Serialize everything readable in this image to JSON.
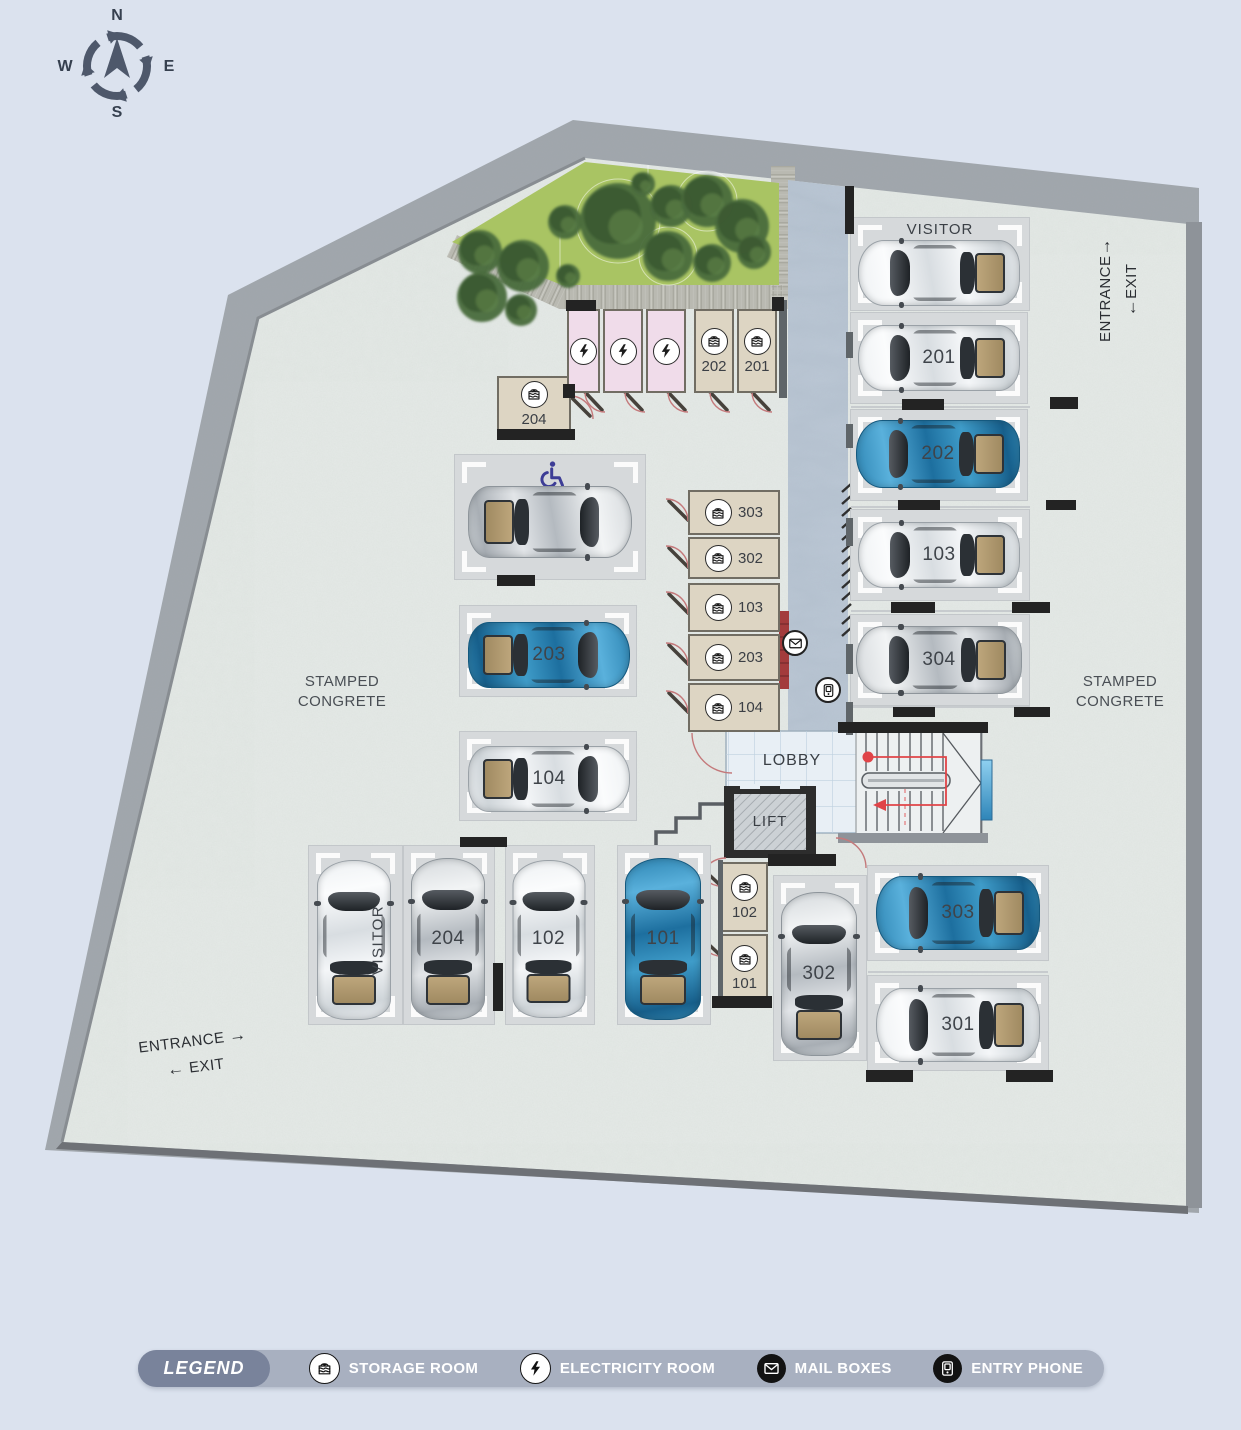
{
  "compass": {
    "north": "N",
    "east": "E",
    "south": "S",
    "west": "W"
  },
  "plan": {
    "lobby_label": "LOBBY",
    "lift_label": "LIFT",
    "surface_left": {
      "line1": "STAMPED",
      "line2": "CONGRETE"
    },
    "surface_right": {
      "line1": "STAMPED",
      "line2": "CONGRETE"
    },
    "entrance_right": {
      "entrance": "ENTRANCE",
      "exit": "EXIT",
      "entrance_arrow": "→",
      "exit_arrow": "←"
    },
    "entrance_bottom": {
      "entrance": "ENTRANCE",
      "exit": "EXIT",
      "entrance_arrow": "→",
      "exit_arrow": "←"
    }
  },
  "parking_stalls": [
    {
      "id": "visitor-top",
      "label": "VISITOR",
      "label_style": "top",
      "car": "white",
      "rect": [
        851,
        218,
        178,
        92
      ],
      "car_rect": [
        858,
        240,
        162,
        66
      ],
      "rot": -90
    },
    {
      "id": "201",
      "label": "201",
      "label_style": "on-car",
      "car": "white",
      "rect": [
        851,
        313,
        176,
        90
      ],
      "car_rect": [
        858,
        325,
        162,
        66
      ],
      "rot": -90
    },
    {
      "id": "202",
      "label": "202",
      "label_style": "on-car",
      "car": "blue",
      "rect": [
        851,
        410,
        176,
        90
      ],
      "car_rect": [
        856,
        420,
        164,
        68
      ],
      "rot": -90
    },
    {
      "id": "103",
      "label": "103",
      "label_style": "on-car",
      "car": "white",
      "rect": [
        851,
        510,
        178,
        90
      ],
      "car_rect": [
        858,
        522,
        162,
        66
      ],
      "rot": -90
    },
    {
      "id": "304",
      "label": "304",
      "label_style": "on-car",
      "car": "silver",
      "rect": [
        851,
        615,
        178,
        90
      ],
      "car_rect": [
        856,
        626,
        166,
        68
      ],
      "rot": -90
    },
    {
      "id": "handicap",
      "label": "",
      "label_style": "handicap",
      "car": "silver",
      "rect": [
        455,
        455,
        190,
        124
      ],
      "car_rect": [
        468,
        486,
        164,
        72
      ],
      "rot": 90
    },
    {
      "id": "203",
      "label": "203",
      "label_style": "on-car",
      "car": "blue",
      "rect": [
        460,
        606,
        176,
        90
      ],
      "car_rect": [
        468,
        622,
        162,
        66
      ],
      "rot": 90
    },
    {
      "id": "104",
      "label": "104",
      "label_style": "on-car",
      "car": "white",
      "rect": [
        460,
        732,
        176,
        88
      ],
      "car_rect": [
        468,
        746,
        162,
        66
      ],
      "rot": 90
    },
    {
      "id": "visitor-bottom",
      "label": "VISITOR",
      "label_style": "side",
      "car": "white",
      "rect": [
        309,
        846,
        93,
        178
      ],
      "car_rect": [
        317,
        860,
        74,
        160
      ],
      "rot": 0
    },
    {
      "id": "204",
      "label": "204",
      "label_style": "on-car",
      "car": "silver",
      "rect": [
        404,
        846,
        90,
        178
      ],
      "car_rect": [
        411,
        858,
        74,
        162
      ],
      "rot": 0
    },
    {
      "id": "102",
      "label": "102",
      "label_style": "on-car",
      "car": "white",
      "rect": [
        506,
        846,
        88,
        178
      ],
      "car_rect": [
        512,
        860,
        73,
        158
      ],
      "rot": 0
    },
    {
      "id": "101",
      "label": "101",
      "label_style": "on-car",
      "car": "blue",
      "rect": [
        618,
        846,
        92,
        178
      ],
      "car_rect": [
        625,
        858,
        76,
        162
      ],
      "rot": 0
    },
    {
      "id": "302",
      "label": "302",
      "label_style": "on-car",
      "car": "silver",
      "rect": [
        774,
        876,
        92,
        184
      ],
      "car_rect": [
        781,
        892,
        76,
        164
      ],
      "rot": 0
    },
    {
      "id": "303",
      "label": "303",
      "label_style": "on-car",
      "car": "blue",
      "rect": [
        868,
        866,
        180,
        94
      ],
      "car_rect": [
        876,
        876,
        164,
        74
      ],
      "rot": -90
    },
    {
      "id": "301",
      "label": "301",
      "label_style": "on-car",
      "car": "white",
      "rect": [
        868,
        976,
        180,
        94
      ],
      "car_rect": [
        876,
        988,
        164,
        74
      ],
      "rot": -90
    }
  ],
  "storage_rooms": [
    {
      "number": "204",
      "rect": [
        497,
        376,
        74,
        56
      ],
      "layout": "stack"
    },
    {
      "number": "202",
      "rect": [
        694,
        309,
        40,
        84
      ],
      "layout": "stack"
    },
    {
      "number": "201",
      "rect": [
        737,
        309,
        40,
        84
      ],
      "layout": "stack"
    },
    {
      "number": "303",
      "rect": [
        688,
        490,
        92,
        45
      ],
      "layout": "row"
    },
    {
      "number": "302",
      "rect": [
        688,
        537,
        92,
        42
      ],
      "layout": "row"
    },
    {
      "number": "103",
      "rect": [
        688,
        583,
        92,
        49
      ],
      "layout": "row"
    },
    {
      "number": "203",
      "rect": [
        688,
        634,
        92,
        47
      ],
      "layout": "row"
    },
    {
      "number": "104",
      "rect": [
        688,
        683,
        92,
        49
      ],
      "layout": "row"
    },
    {
      "number": "102",
      "rect": [
        721,
        862,
        47,
        70
      ],
      "layout": "stack"
    },
    {
      "number": "101",
      "rect": [
        721,
        934,
        47,
        69
      ],
      "layout": "stack"
    }
  ],
  "electricity_rooms": [
    {
      "rect": [
        567,
        309,
        33,
        84
      ]
    },
    {
      "rect": [
        603,
        309,
        40,
        84
      ]
    },
    {
      "rect": [
        646,
        309,
        40,
        84
      ]
    }
  ],
  "decor": {
    "wall_bars": [
      [
        566,
        300,
        30,
        11
      ],
      [
        772,
        297,
        12,
        14
      ],
      [
        497,
        429,
        78,
        11
      ],
      [
        563,
        384,
        12,
        14
      ],
      [
        460,
        837,
        47,
        10
      ],
      [
        493,
        963,
        10,
        48
      ],
      [
        866,
        1070,
        47,
        12
      ],
      [
        1006,
        1070,
        47,
        12
      ],
      [
        902,
        399,
        42,
        11
      ],
      [
        1050,
        397,
        28,
        12
      ],
      [
        898,
        500,
        42,
        10
      ],
      [
        1046,
        500,
        30,
        10
      ],
      [
        891,
        602,
        44,
        11
      ],
      [
        1012,
        602,
        38,
        11
      ],
      [
        893,
        707,
        42,
        10
      ],
      [
        1014,
        707,
        36,
        10
      ],
      [
        497,
        575,
        38,
        11
      ],
      [
        712,
        996,
        60,
        12
      ],
      [
        768,
        854,
        68,
        12
      ],
      [
        845,
        186,
        9,
        48
      ],
      [
        838,
        722,
        150,
        11
      ]
    ],
    "wall_segs": [
      [
        846,
        332,
        7,
        26
      ],
      [
        846,
        424,
        7,
        24
      ],
      [
        846,
        518,
        7,
        28
      ],
      [
        846,
        644,
        7,
        30
      ],
      [
        846,
        702,
        7,
        33
      ],
      [
        779,
        300,
        8,
        98
      ],
      [
        718,
        860,
        5,
        138
      ]
    ],
    "trees": [
      [
        480,
        252,
        22
      ],
      [
        523,
        266,
        26
      ],
      [
        568,
        276,
        12
      ],
      [
        482,
        297,
        25
      ],
      [
        521,
        310,
        16
      ],
      [
        565,
        222,
        17
      ],
      [
        618,
        221,
        38
      ],
      [
        643,
        184,
        12
      ],
      [
        671,
        206,
        21
      ],
      [
        707,
        201,
        26
      ],
      [
        668,
        256,
        25
      ],
      [
        712,
        263,
        19
      ],
      [
        742,
        226,
        27
      ],
      [
        754,
        252,
        17
      ]
    ]
  },
  "legend": {
    "title": "LEGEND",
    "items": [
      {
        "icon": "storage-room-icon",
        "label": "STORAGE ROOM"
      },
      {
        "icon": "electricity-room-icon",
        "label": "ELECTRICITY ROOM"
      },
      {
        "icon": "mailboxes-icon",
        "label": "MAIL BOXES"
      },
      {
        "icon": "entry-phone-icon",
        "label": "ENTRY PHONE"
      }
    ]
  },
  "colors": {
    "car_blue": "#2e8fc0",
    "car_silver": "#c7ccd1",
    "car_white": "#f1f3f5",
    "site_concrete": "#e5eae7",
    "road_gray": "#a0a6ac",
    "green": "#a9c463",
    "walkway": "#b5c2d0",
    "room_tan": "#ddd5c3",
    "room_pink": "#f0dcea",
    "mail_red": "#a33b3c",
    "legend_bar": "#a8b0c0",
    "legend_pill": "#79839b",
    "stair_red": "#e04448",
    "window_blue": "#53aede"
  }
}
